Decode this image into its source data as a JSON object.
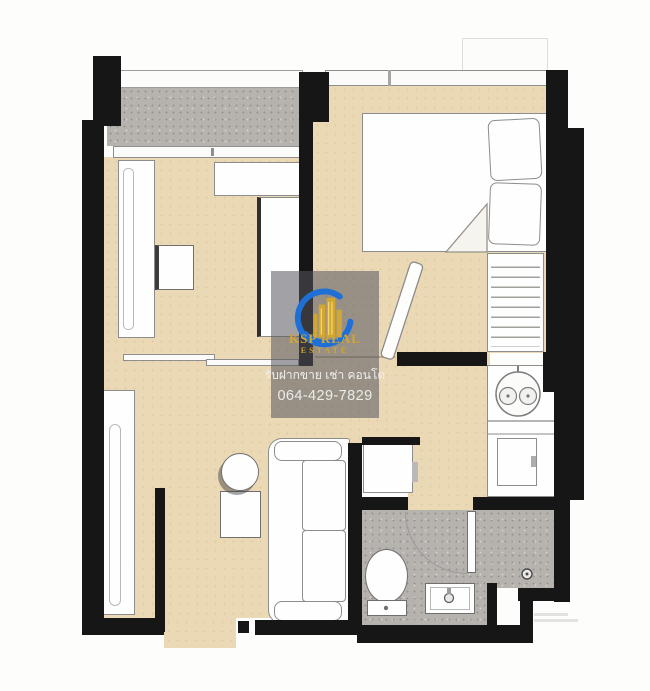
{
  "watermark": {
    "brand_line1": "KSP REAL",
    "brand_line2": "ESTATE",
    "thai_line": "รับฝากขาย เช่า คอนโด",
    "phone": "064-429-7829"
  },
  "colors": {
    "wall": "#161616",
    "floor_beige": "#ebd9b6",
    "balcony_gray": "#b6b2ae",
    "overlay": "rgba(84,84,92,0.55)",
    "logo_blue": "#1e6fd6",
    "logo_gold": "#d2a633"
  },
  "floorplan": {
    "type": "condo-unit-floor-plan",
    "rooms": [
      "balcony",
      "second-room",
      "bedroom",
      "walk-in-closet",
      "kitchen",
      "bathroom",
      "shower",
      "living-dining",
      "entrance"
    ]
  }
}
